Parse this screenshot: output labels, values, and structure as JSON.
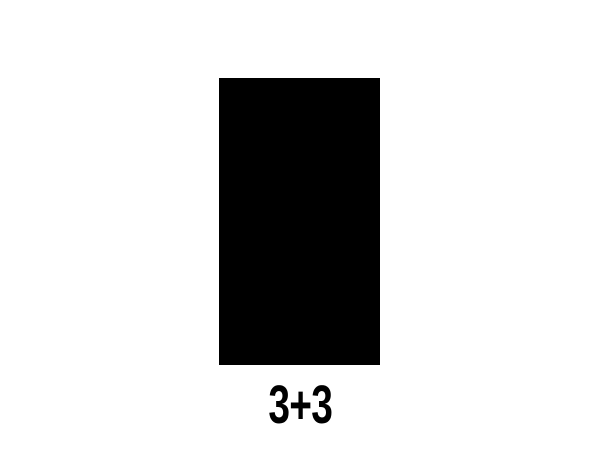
{
  "card": {
    "expression": "3+3"
  },
  "colors": {
    "background": "#ffffff",
    "rectangle": "#000000",
    "text": "#000000"
  }
}
